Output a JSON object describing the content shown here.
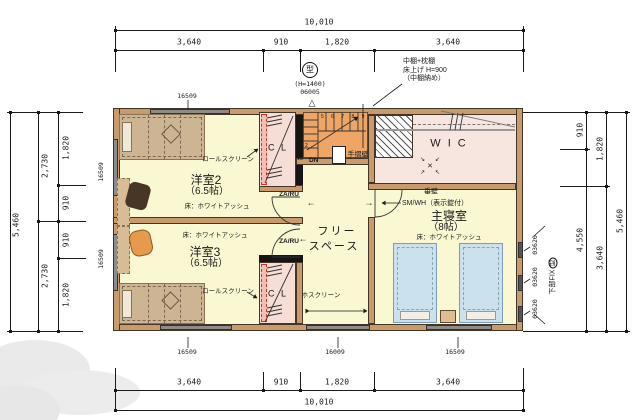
{
  "dimensions": {
    "top": {
      "total": "10,010",
      "segments": [
        "3,640",
        "910",
        "1,820",
        "3,640"
      ]
    },
    "bottom": {
      "total": "10,010",
      "segments": [
        "3,640",
        "910",
        "1,820",
        "3,640"
      ]
    },
    "left": {
      "total": "5,460",
      "halves": [
        "2,730",
        "2,730"
      ],
      "segments": [
        "1,820",
        "910",
        "910",
        "1,820"
      ]
    },
    "right": {
      "total": "5,460",
      "inner": [
        "910",
        "4,550"
      ],
      "outer": [
        "1,820",
        "3,640"
      ]
    }
  },
  "windows": {
    "top": "16509",
    "left": [
      "16509",
      "16509"
    ],
    "bottom": [
      "16509",
      "16009",
      "16509"
    ],
    "right": [
      "03620",
      "03620",
      "03620"
    ]
  },
  "rooms": {
    "yoshitsu2": {
      "name": "洋室2",
      "size": "（6.5帖）",
      "floor": "床：ホワイトアッシュ"
    },
    "yoshitsu3": {
      "name": "洋室3",
      "size": "（6.5帖）",
      "floor": "床：ホワイトアッシュ"
    },
    "master": {
      "name": "主寝室",
      "size": "（8帖）",
      "floor": "床：ホワイトアッシュ"
    },
    "free_space": {
      "line1": "フリー",
      "line2": "スペース"
    },
    "wic": {
      "name": "W I C"
    },
    "closet": {
      "label": "C L"
    }
  },
  "annotations": {
    "roll_screen": "ロールスクリーン",
    "hoscreen": "ホスクリーン",
    "handrail": "手摺壁",
    "down": "DN",
    "step_13": "13",
    "step_2": "2",
    "steps_top": "5 6 7 8 9",
    "door_code": "ZA/RU",
    "hanging_wall": "垂壁",
    "master_door": "SM/WH（表示錠付）",
    "shelf_note1": "中棚+枕棚",
    "shelf_note2": "床上げ H=900",
    "shelf_note3": "（中棚納め）",
    "glass_type": "型",
    "glass_height": "(H=1400)",
    "glass_code": "06005",
    "fix_note": "下部FIX",
    "fix_type": "型"
  },
  "icons": {
    "window_marker": "△",
    "arrow_left": "←",
    "arrow_right": "→",
    "cross": "×",
    "corner_tl": "↘",
    "corner_tr": "↙",
    "corner_bl": "↗",
    "corner_br": "↖"
  },
  "colors": {
    "wall": "#C89B6E",
    "floor": "#FAF8D2",
    "wic_floor": "#F7E6DF",
    "closet": "#F6DED7",
    "stairs": "#EFA566",
    "bed": "#CDB594",
    "bed_blue": "#CBE2EE"
  }
}
